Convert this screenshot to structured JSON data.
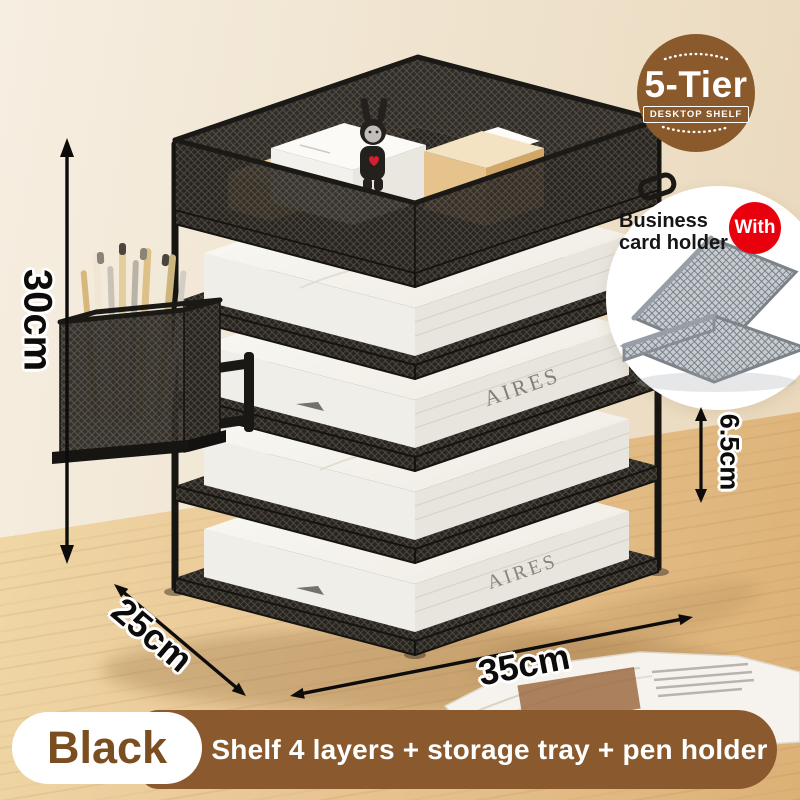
{
  "badge": {
    "title": "5-Tier",
    "subtitle": "DESKTOP SHELF"
  },
  "callout": {
    "line1": "Business",
    "line2": "card holder",
    "with_label": "With"
  },
  "dimensions": {
    "height": "30cm",
    "tier_height": "6.5cm",
    "depth": "25cm",
    "width": "35cm"
  },
  "footer": {
    "color_label": "Black",
    "description": "Shelf 4 layers + storage tray + pen holder"
  },
  "product": {
    "paper_spine_text": "AIRES"
  },
  "colors": {
    "brand_brown": "#8a5a2c",
    "bar_brown": "#8a5a2e",
    "label_brown": "#7b4e22",
    "accent_red": "#e8000d",
    "dimension_black": "#0d0c0a",
    "shelf_black": "#1b1916",
    "desk_wood": "#e9c795",
    "wall_beige": "#f1e7d7"
  }
}
